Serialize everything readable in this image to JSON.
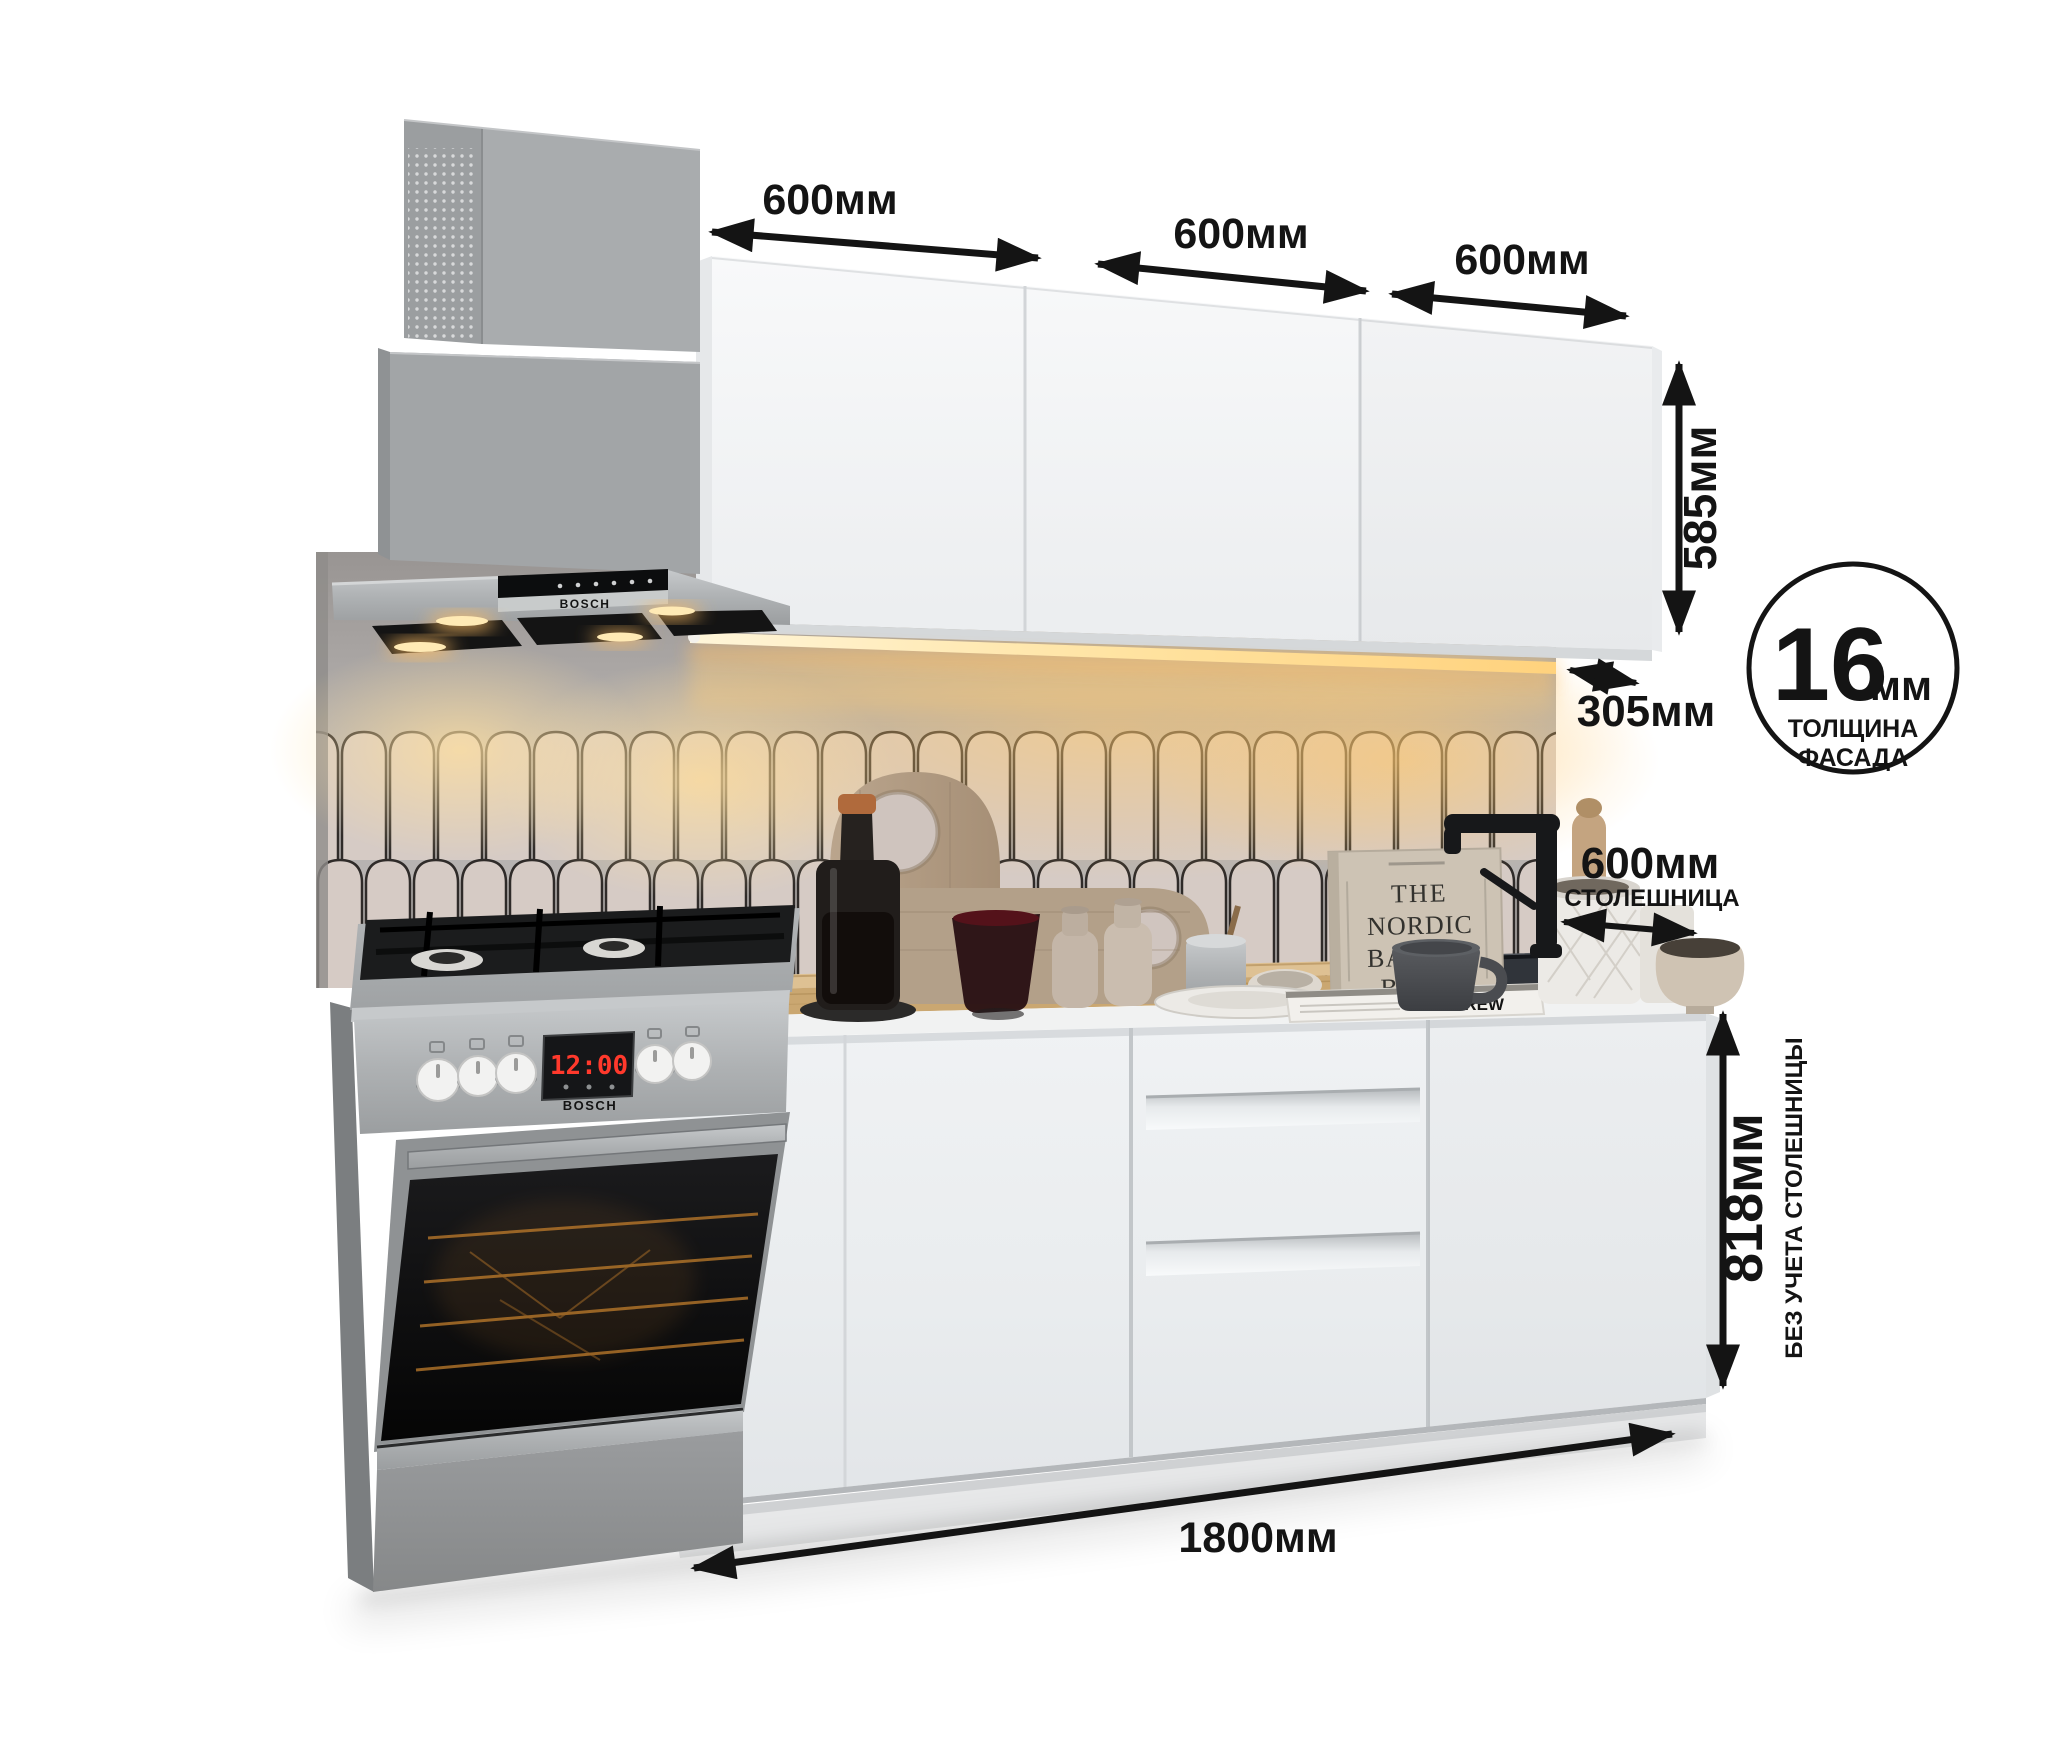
{
  "annotations": {
    "top_widths": [
      {
        "label": "600мм"
      },
      {
        "label": "600мм"
      },
      {
        "label": "600мм"
      }
    ],
    "cabinet_height": {
      "label": "585мм"
    },
    "cabinet_depth": {
      "label": "305мм"
    },
    "countertop_depth": {
      "label": "600мм",
      "caption": "СТОЛЕШНИЦА"
    },
    "base_height": {
      "label": "818мм",
      "caption": "БЕЗ УЧЕТА СТОЛЕШНИЦЫ"
    },
    "total_width": {
      "label": "1800мм"
    },
    "facade_badge": {
      "value": "16",
      "unit": "мм",
      "line1": "ТОЛЩИНА",
      "line2": "ФАСАДА"
    }
  },
  "appliances": {
    "hood_brand": "BOSCH",
    "stove_brand": "BOSCH",
    "stove_clock": "12:00"
  },
  "decor": {
    "book_title_lines": [
      "THE",
      "NORDIC",
      "BAKING",
      "BOOK"
    ],
    "book_spine_text": "BREW"
  },
  "colors": {
    "annotation": "#141414",
    "wall": "#b7b3b1",
    "tile": "#d6cbc5",
    "countertop_wood": "#caa771",
    "led_glow": "#ffc86e",
    "steel": "#a9acae"
  }
}
